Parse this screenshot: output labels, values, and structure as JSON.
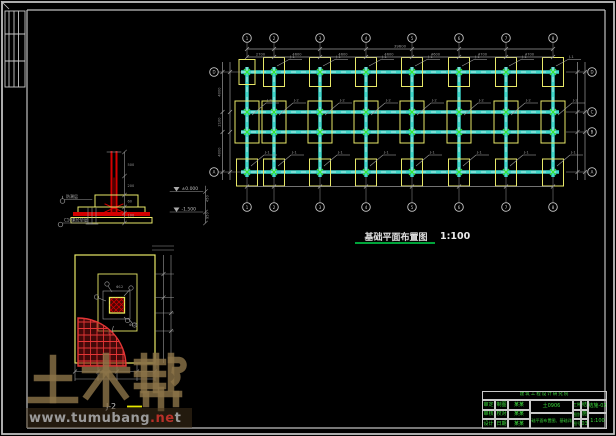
{
  "sheet": {
    "background": "#000000",
    "frame_color": "#c8c8c8"
  },
  "plan": {
    "title": "基础平面布置图",
    "scale": "1:100",
    "columns": [
      247,
      274,
      320,
      366,
      412,
      459,
      506,
      553
    ],
    "rows": [
      72,
      112,
      132,
      172
    ],
    "col_labels": [
      "1",
      "2",
      "3",
      "4",
      "5",
      "6",
      "7",
      "8"
    ],
    "row_labels_right": [
      "D",
      "C",
      "B",
      "A"
    ],
    "row_labels_left": [
      "D",
      "A"
    ],
    "dims_top": [
      "2700",
      "4600",
      "4600",
      "4600",
      "4600",
      "4700",
      "4700"
    ],
    "dims_total": "39600",
    "dims_left": [
      "4000",
      "2100",
      "4000"
    ],
    "footing_label": "J-1",
    "footing_label_mid": "J-2"
  },
  "section_detail": {
    "elevation_top": "±0.000",
    "elevation_bottom": "-1.500",
    "callout_upper": "防潮层",
    "callout_lower": "C10素砼垫层",
    "dims_mid": [
      "500",
      "200",
      "60",
      "100"
    ],
    "dims_right": [
      "450",
      "950"
    ]
  },
  "detail_plan": {
    "title": "J-2",
    "rebar_label_1": "Φ12",
    "rebar_label_2": "Φ12"
  },
  "watermark": {
    "brand": "土木帮",
    "url_gray": "www.tumubang",
    "url_red": ".ne",
    "url_tail": "t"
  },
  "titleblock": {
    "company": "建筑工程设计研究院",
    "project_no": "土0906",
    "content_title": "基础平面布置图、基础详图",
    "left_rows": [
      {
        "a": "审定",
        "b": "制图",
        "c": "某某"
      },
      {
        "a": "审核",
        "b": "校对",
        "c": "某某"
      },
      {
        "a": "设计",
        "b": "日期",
        "c": "某某"
      }
    ],
    "right_rows": [
      {
        "a": "工种",
        "b": "结"
      },
      {
        "a": "图别",
        "b": "施"
      },
      {
        "a": "图号",
        "b": "03"
      }
    ],
    "drawing_no": "结施-03",
    "scale_value": "1:100"
  },
  "colors": {
    "beam": "#3ed8cc",
    "pad": "#e8e868",
    "marker": "#33e633",
    "dim": "#9a9a9a",
    "grid": "#c8c8c8",
    "red": "#d40000",
    "green_text": "#3bdb3b",
    "underline_green": "#00a43a"
  }
}
